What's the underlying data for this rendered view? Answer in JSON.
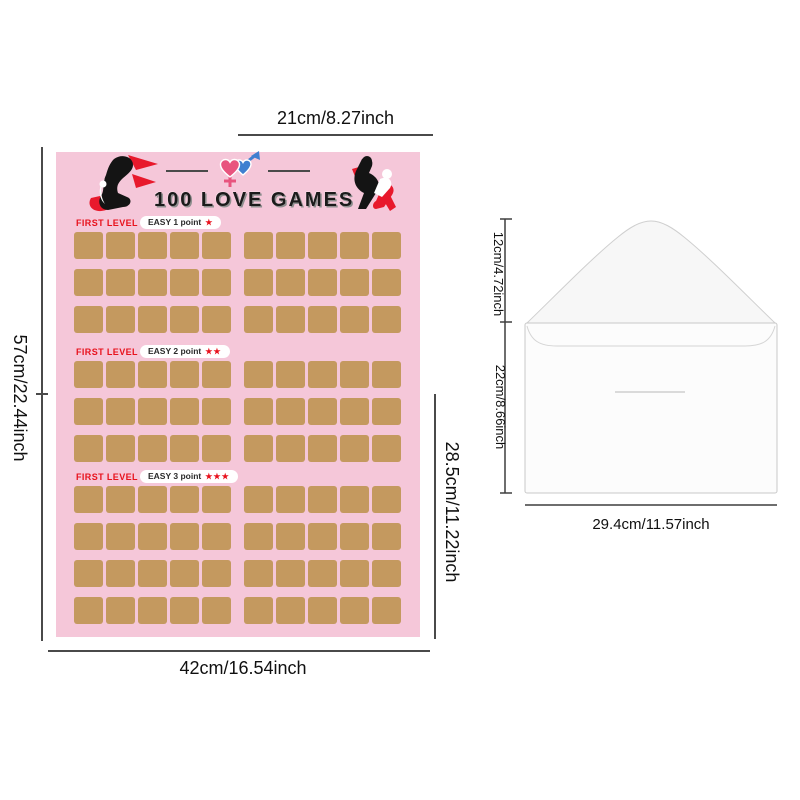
{
  "poster": {
    "title": "100 LOVE GAMES",
    "background_color": "#f5c7d9",
    "square_color": "#c4995f",
    "accent_red": "#e8111c",
    "female_heart_color": "#e8547e",
    "male_heart_color": "#3f7fd0",
    "sections": [
      {
        "level_label": "FIRST LEVEL",
        "difficulty_label": "EASY 1 point",
        "stars": 1,
        "rows": 3,
        "columns": 10
      },
      {
        "level_label": "FIRST LEVEL",
        "difficulty_label": "EASY 2 point",
        "stars": 2,
        "rows": 3,
        "columns": 10
      },
      {
        "level_label": "FIRST LEVEL",
        "difficulty_label": "EASY 3 point",
        "stars": 3,
        "rows": 4,
        "columns": 10
      }
    ],
    "dimensions": {
      "top": "21cm/8.27inch",
      "left": "57cm/22.44inch",
      "right": "28.5cm/11.22inch",
      "bottom": "42cm/16.54inch"
    }
  },
  "envelope": {
    "dimensions": {
      "flap": "12cm/4.72inch",
      "body": "22cm/8.66inch",
      "width": "29.4cm/11.57inch"
    }
  }
}
